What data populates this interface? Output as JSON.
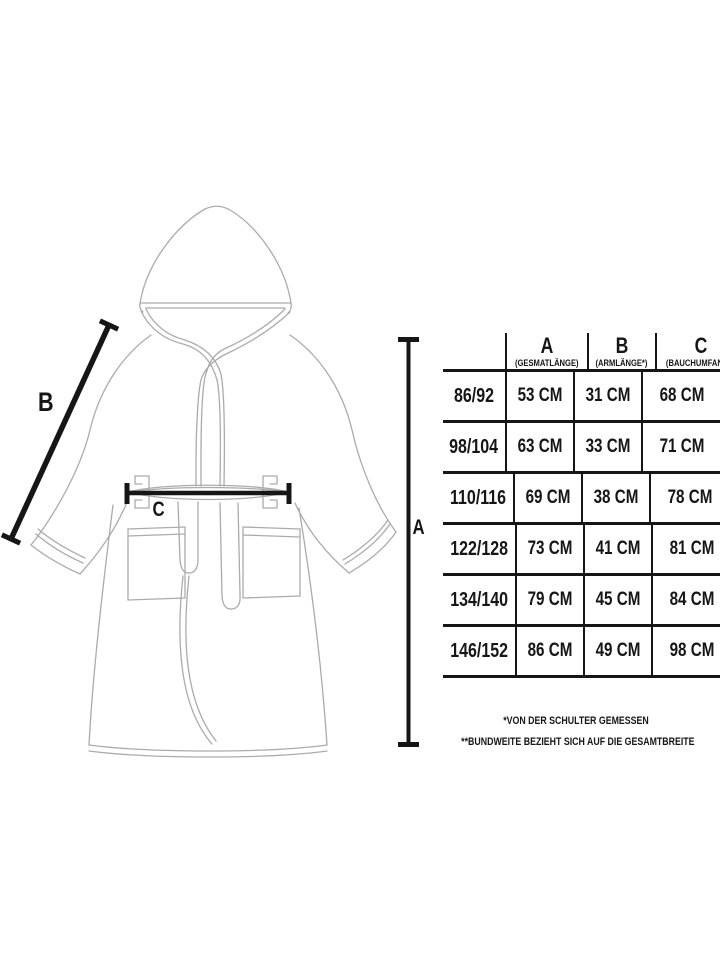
{
  "labels": {
    "a": "A",
    "b": "B",
    "c": "C"
  },
  "table": {
    "columns": [
      {
        "letter": "A",
        "subtitle": "(GESMATLÄNGE)"
      },
      {
        "letter": "B",
        "subtitle": "(ARMLÄNGE*)"
      },
      {
        "letter": "C",
        "subtitle": "(BAUCHUMFANG**)"
      }
    ],
    "rows": [
      {
        "size": "86/92",
        "a": "53 CM",
        "b": "31 CM",
        "c": "68 CM"
      },
      {
        "size": "98/104",
        "a": "63 CM",
        "b": "33 CM",
        "c": "71 CM"
      },
      {
        "size": "110/116",
        "a": "69 CM",
        "b": "38 CM",
        "c": "78 CM"
      },
      {
        "size": "122/128",
        "a": "73 CM",
        "b": "41 CM",
        "c": "81 CM"
      },
      {
        "size": "134/140",
        "a": "79 CM",
        "b": "45 CM",
        "c": "84 CM"
      },
      {
        "size": "146/152",
        "a": "86 CM",
        "b": "49 CM",
        "c": "98 CM"
      }
    ]
  },
  "footnotes": {
    "line1": "*VON DER SCHULTER GEMESSEN",
    "line2": "**BUNDWEITE BEZIEHT SICH AUF DIE GESAMTBREITE"
  },
  "colors": {
    "ink": "#161616",
    "outline": "#ababab"
  }
}
